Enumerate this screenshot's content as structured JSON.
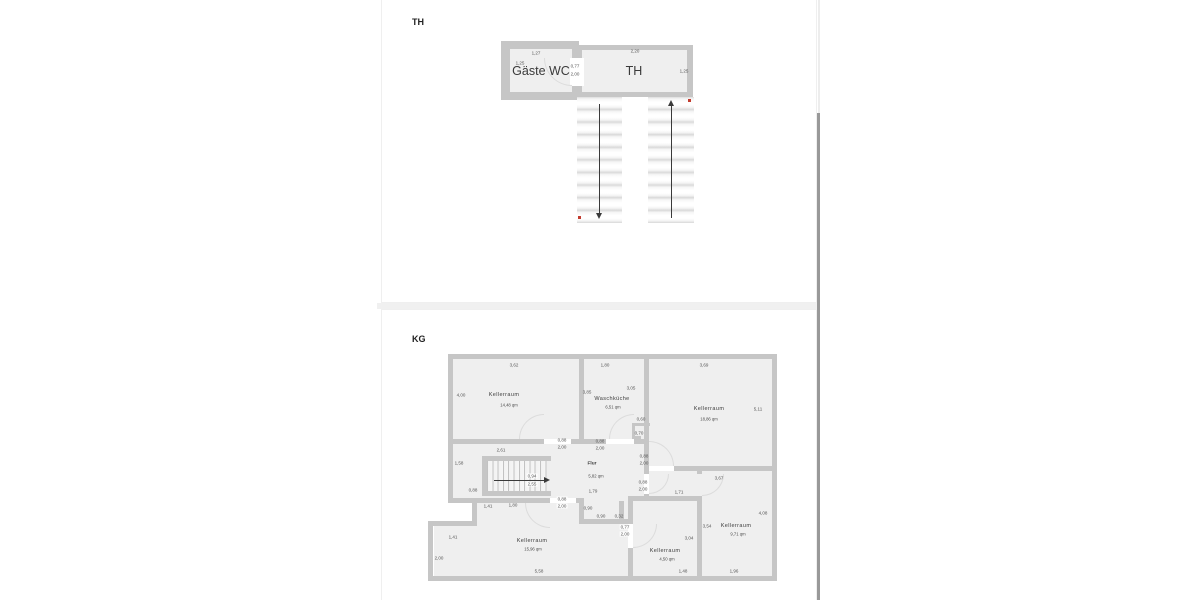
{
  "viewer": {
    "scrollbar": "vertical"
  },
  "colors": {
    "wall": "#c6c6c6",
    "floor": "#efefef",
    "red_marker": "#c23b2e"
  },
  "page1": {
    "tag": "TH",
    "rooms": [
      {
        "name": "Gäste WC"
      },
      {
        "name": "TH"
      }
    ],
    "labels": [
      {
        "t": "1,27",
        "x": 154,
        "y": 53
      },
      {
        "t": "1,25",
        "x": 138,
        "y": 63
      },
      {
        "t": "Gäste WC",
        "x": 159,
        "y": 71,
        "cls": "big",
        "n": "room-label-gaeste-wc"
      },
      {
        "t": "0,77",
        "x": 193,
        "y": 66
      },
      {
        "t": "2,00",
        "x": 193,
        "y": 74
      },
      {
        "t": "2,20",
        "x": 253,
        "y": 51
      },
      {
        "t": "TH",
        "x": 252,
        "y": 71,
        "cls": "big",
        "n": "room-label-th"
      },
      {
        "t": "1,25",
        "x": 302,
        "y": 71
      }
    ]
  },
  "page2": {
    "tag": "KG",
    "rooms": [
      {
        "name": "Kellerraum",
        "size": "14,48 qm"
      },
      {
        "name": "Waschküche",
        "size": "6,51 qm"
      },
      {
        "name": "Kellerraum",
        "size": "18,86 qm"
      },
      {
        "name": "Flur",
        "size": "5,82 qm"
      },
      {
        "name": "Kellerraum",
        "size": "15,96 qm"
      },
      {
        "name": "Kellerraum",
        "size": "4,50 qm"
      },
      {
        "name": "Kellerraum",
        "size": "9,71 qm"
      }
    ],
    "labels": [
      {
        "t": "3,62",
        "x": 132,
        "y": 55
      },
      {
        "t": "4,00",
        "x": 79,
        "y": 85
      },
      {
        "t": "Kellerraum",
        "x": 122,
        "y": 85,
        "cls": "room",
        "n": "room-label-kellerraum-1"
      },
      {
        "t": "14,48 qm",
        "x": 127,
        "y": 95,
        "cls": "area"
      },
      {
        "t": "1,80",
        "x": 223,
        "y": 55
      },
      {
        "t": "3,85",
        "x": 205,
        "y": 82
      },
      {
        "t": "3,05",
        "x": 249,
        "y": 78
      },
      {
        "t": "Waschküche",
        "x": 230,
        "y": 89,
        "cls": "room",
        "n": "room-label-waschkueche"
      },
      {
        "t": "6,51 qm",
        "x": 231,
        "y": 97,
        "cls": "area"
      },
      {
        "t": "0,60",
        "x": 259,
        "y": 109
      },
      {
        "t": "0,70",
        "x": 257,
        "y": 123
      },
      {
        "t": "3,69",
        "x": 322,
        "y": 55
      },
      {
        "t": "Kellerraum",
        "x": 327,
        "y": 99,
        "cls": "room",
        "n": "room-label-kellerraum-2"
      },
      {
        "t": "18,86 qm",
        "x": 327,
        "y": 109,
        "cls": "area"
      },
      {
        "t": "5,11",
        "x": 376,
        "y": 99
      },
      {
        "t": "0,88",
        "x": 180,
        "y": 130
      },
      {
        "t": "2,00",
        "x": 180,
        "y": 137
      },
      {
        "t": "0,88",
        "x": 218,
        "y": 131
      },
      {
        "t": "2,00",
        "x": 218,
        "y": 138
      },
      {
        "t": "2,61",
        "x": 119,
        "y": 140
      },
      {
        "t": "1,58",
        "x": 77,
        "y": 153
      },
      {
        "t": "Flur",
        "x": 210,
        "y": 154,
        "cls": "roomsm",
        "n": "room-label-flur"
      },
      {
        "t": "5,82 qm",
        "x": 214,
        "y": 166,
        "cls": "area"
      },
      {
        "t": "0,88",
        "x": 262,
        "y": 146
      },
      {
        "t": "2,00",
        "x": 262,
        "y": 153
      },
      {
        "t": "0,88",
        "x": 261,
        "y": 172
      },
      {
        "t": "2,00",
        "x": 261,
        "y": 179
      },
      {
        "t": "3,67",
        "x": 337,
        "y": 168
      },
      {
        "t": "1,71",
        "x": 297,
        "y": 182
      },
      {
        "t": "0,94",
        "x": 150,
        "y": 166,
        "bg": true
      },
      {
        "t": "2,55",
        "x": 150,
        "y": 174,
        "bg": true
      },
      {
        "t": "0,88",
        "x": 91,
        "y": 180
      },
      {
        "t": "1,79",
        "x": 211,
        "y": 181
      },
      {
        "t": "0,88",
        "x": 180,
        "y": 189,
        "bg": true
      },
      {
        "t": "2,00",
        "x": 180,
        "y": 196,
        "bg": true
      },
      {
        "t": "1,80",
        "x": 131,
        "y": 195
      },
      {
        "t": "0,90",
        "x": 206,
        "y": 198
      },
      {
        "t": "0,90",
        "x": 219,
        "y": 206
      },
      {
        "t": "0,32",
        "x": 237,
        "y": 206
      },
      {
        "t": "1,41",
        "x": 106,
        "y": 196
      },
      {
        "t": "1,41",
        "x": 71,
        "y": 227
      },
      {
        "t": "2,00",
        "x": 57,
        "y": 248
      },
      {
        "t": "0,77",
        "x": 243,
        "y": 217,
        "bg": true
      },
      {
        "t": "2,00",
        "x": 243,
        "y": 224,
        "bg": true
      },
      {
        "t": "Kellerraum",
        "x": 150,
        "y": 231,
        "cls": "room",
        "n": "room-label-kellerraum-3"
      },
      {
        "t": "15,96 qm",
        "x": 151,
        "y": 239,
        "cls": "area"
      },
      {
        "t": "5,58",
        "x": 157,
        "y": 261
      },
      {
        "t": "Kellerraum",
        "x": 283,
        "y": 241,
        "cls": "room",
        "n": "room-label-kellerraum-4"
      },
      {
        "t": "4,50 qm",
        "x": 285,
        "y": 249,
        "cls": "area"
      },
      {
        "t": "3,04",
        "x": 307,
        "y": 228
      },
      {
        "t": "1,48",
        "x": 301,
        "y": 261
      },
      {
        "t": "3,54",
        "x": 325,
        "y": 216
      },
      {
        "t": "Kellerraum",
        "x": 354,
        "y": 216,
        "cls": "room",
        "n": "room-label-kellerraum-5"
      },
      {
        "t": "9,71 qm",
        "x": 356,
        "y": 224,
        "cls": "area"
      },
      {
        "t": "4,08",
        "x": 381,
        "y": 203
      },
      {
        "t": "1,96",
        "x": 352,
        "y": 261
      }
    ]
  }
}
